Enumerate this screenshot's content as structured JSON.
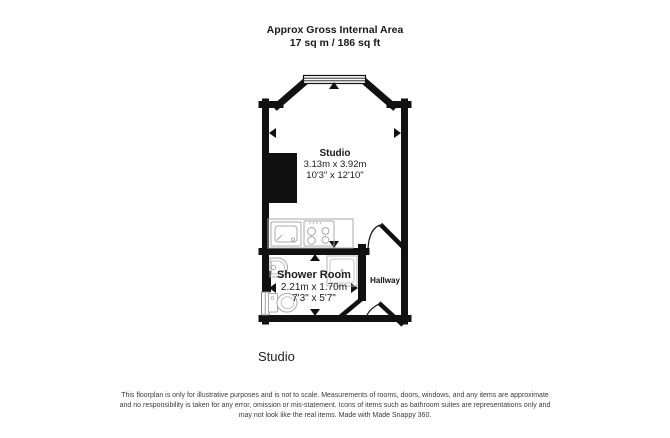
{
  "header": {
    "line1": "Approx Gross Internal Area",
    "line2": "17 sq m / 186 sq ft"
  },
  "rooms": [
    {
      "name": "Studio",
      "metric": "3.13m x 3.92m",
      "imperial": "10'3\" x 12'10\""
    },
    {
      "name": "Shower Room",
      "metric": "2.21m x 1.70m",
      "imperial": "7'3\" x 5'7\""
    },
    {
      "name": "Hallway"
    }
  ],
  "caption": "Studio",
  "disclaimer": [
    "This floorplan is only for illustrative purposes and is not to scale. Measurements of rooms, doors, windows, and any items are approximate",
    "and no responsibility is taken for any error, omission or mis-statement. Icons of items such as bathroom suites are representations only and",
    "may not look like the real items. Made with Made Snappy 360."
  ],
  "icons": [
    "window-icon",
    "kitchen-sink-icon",
    "hob-icon",
    "shower-icon",
    "basin-icon",
    "toilet-icon",
    "door-swing-icon",
    "measure-arrow-icon"
  ],
  "colors": {
    "wall": "#111111",
    "fixture_outline": "#a8a8a8",
    "text": "#1a1a1a",
    "disclaimer_text": "#3a3a3a",
    "background": "#ffffff"
  }
}
